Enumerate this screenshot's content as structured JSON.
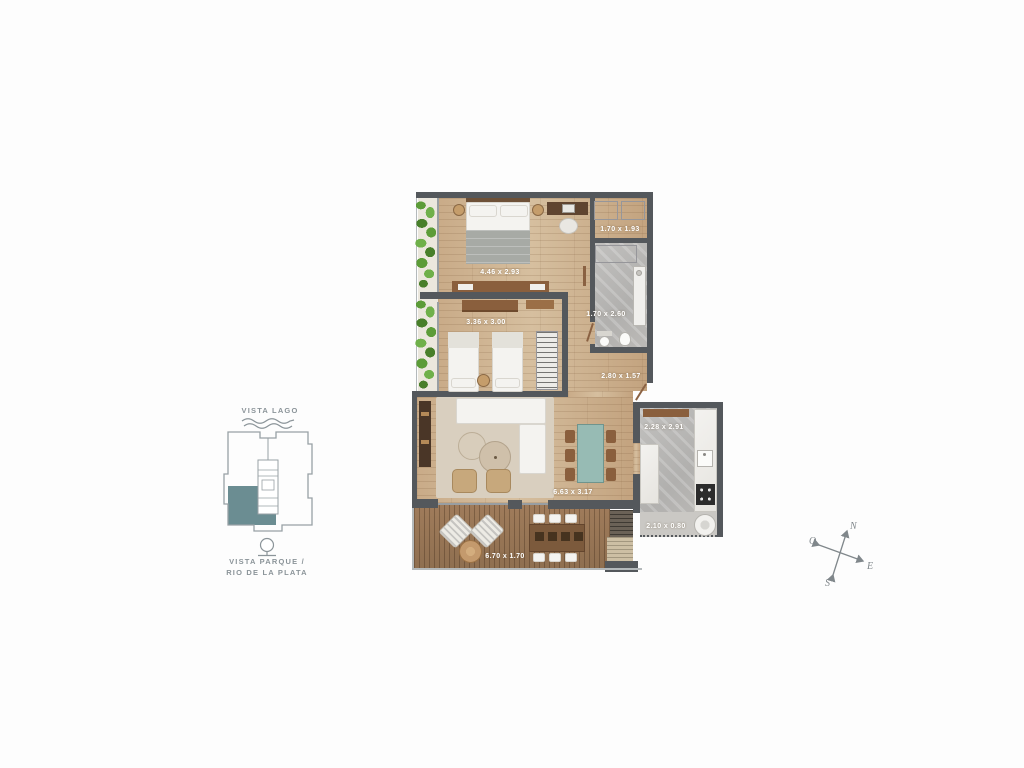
{
  "floorplan": {
    "rooms": [
      {
        "name": "master-bedroom",
        "dims": "4.46 x 2.93"
      },
      {
        "name": "second-bedroom",
        "dims": "3.36 x 3.00"
      },
      {
        "name": "walk-in-closet",
        "dims": "1.70 x 1.93"
      },
      {
        "name": "bathroom",
        "dims": "1.70 x 2.60"
      },
      {
        "name": "hallway",
        "dims": "2.80 x 1.57"
      },
      {
        "name": "living-dining",
        "dims": "6.63 x 3.17"
      },
      {
        "name": "kitchen",
        "dims": "2.28 x 2.91"
      },
      {
        "name": "laundry",
        "dims": "2.10 x 0.80"
      },
      {
        "name": "terrace",
        "dims": "6.70 x 1.70"
      }
    ]
  },
  "keyplan": {
    "view_top": "VISTA LAGO",
    "view_bottom_line1": "VISTA PARQUE /",
    "view_bottom_line2": "RIO DE LA PLATA"
  },
  "compass": {
    "north": "N",
    "south": "S",
    "east": "E",
    "west": "O"
  },
  "icons": [
    "wave-icon",
    "tree-icon",
    "compass-rose"
  ],
  "palette": {
    "wall": "#54585c",
    "wood_floor": "#c9ab88",
    "deck": "#8f6f50",
    "tile": "#b9b8b5",
    "marble": "#f1f0ed",
    "unit_highlight_teal": "#6b8d92",
    "dining_table_teal": "#97bbb4",
    "keyplan_gray": "#8b9499",
    "plant_green": "#5c9c38",
    "furniture_wood": "#8a5f3d",
    "dimension_label": "#ffffff"
  }
}
